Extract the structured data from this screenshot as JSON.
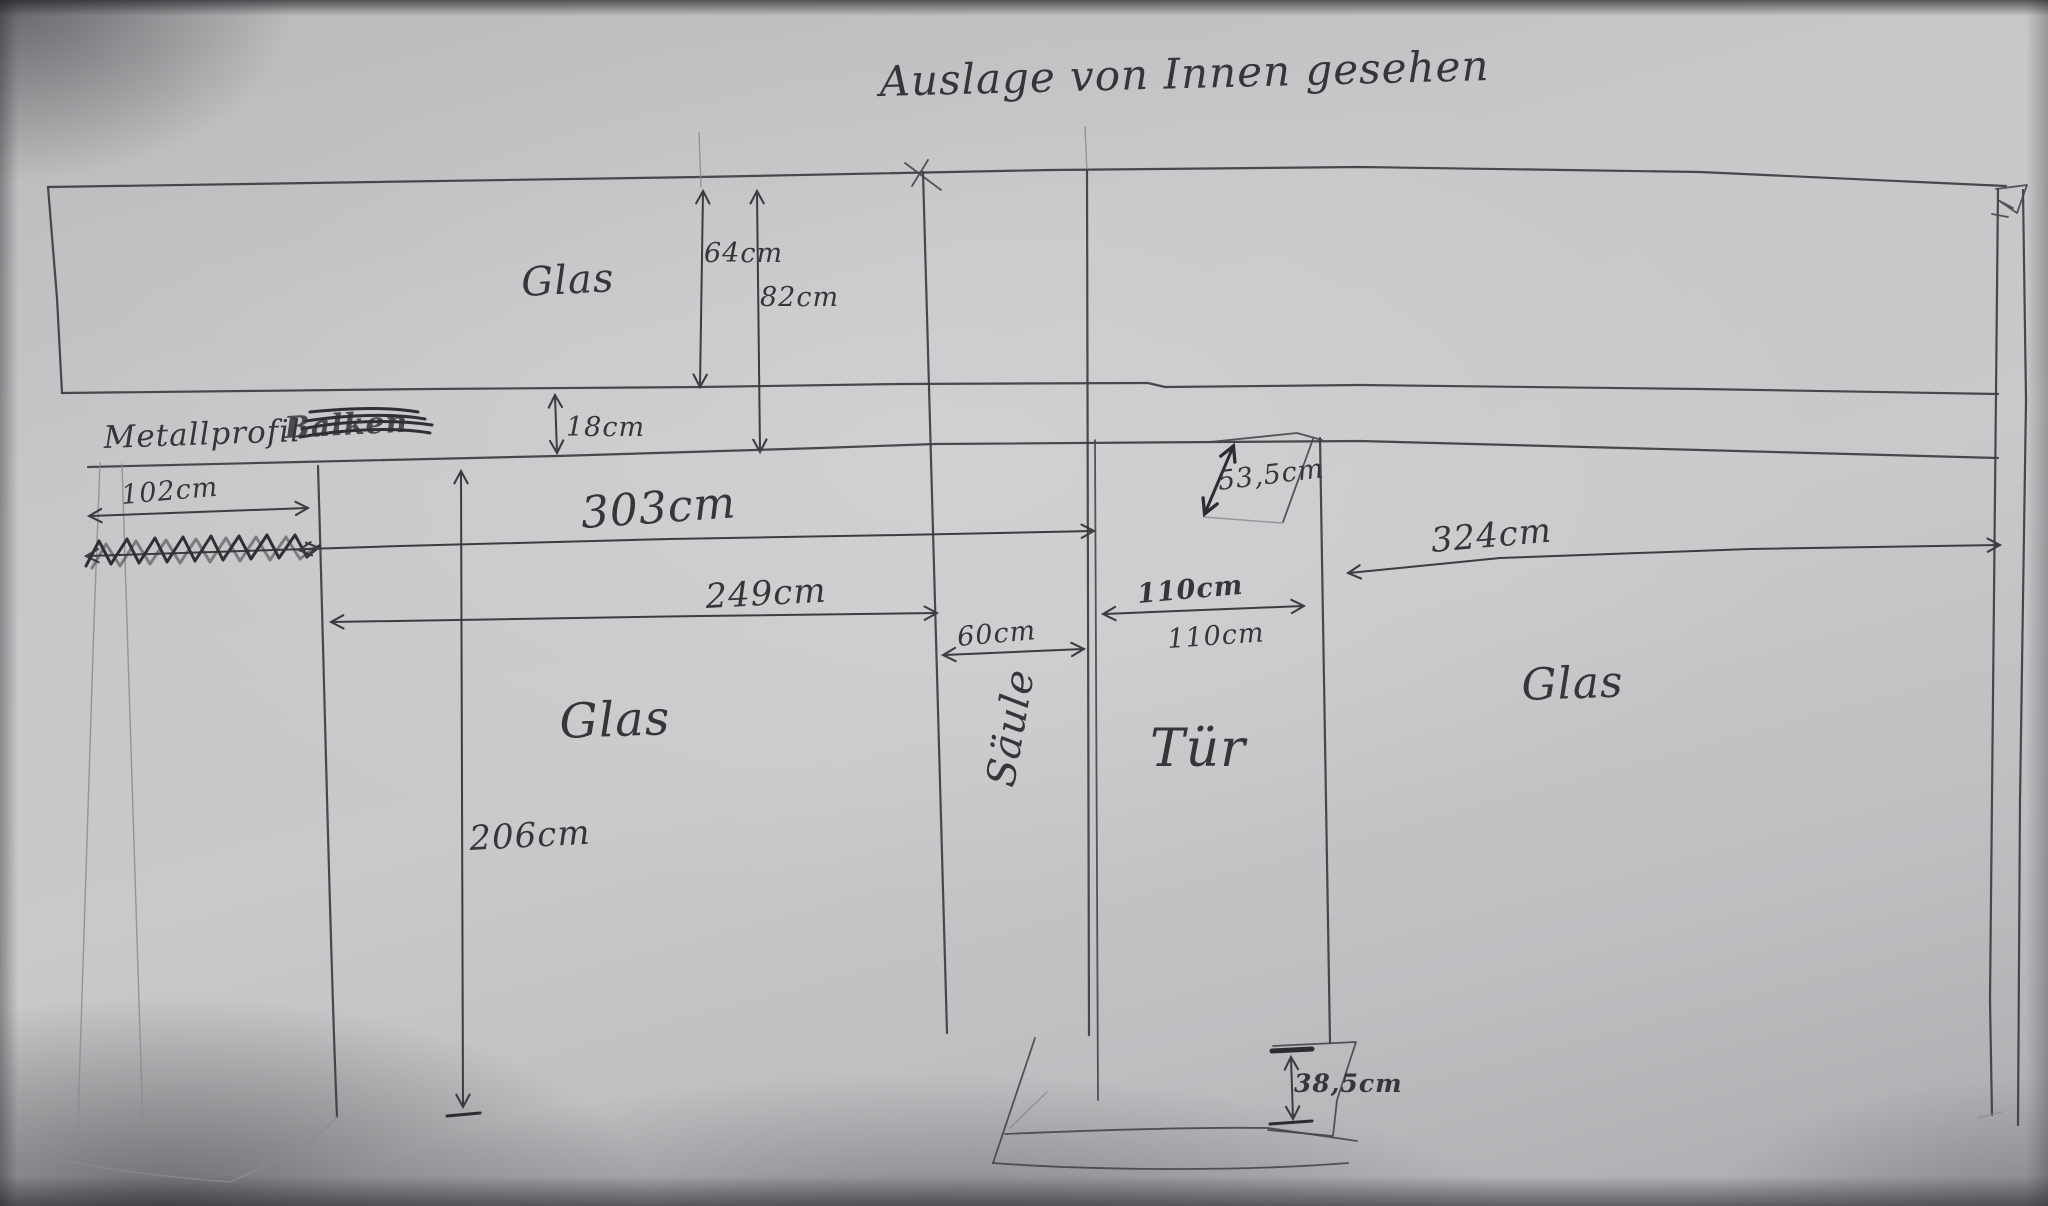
{
  "title": "Auslage von Innen gesehen",
  "labels": {
    "glas_top": "Glas",
    "metallprofil": "Metallprofil",
    "crossed_word": "Balken",
    "glas_left": "Glas",
    "saeule": "Säule",
    "tuer": "Tür",
    "glas_right": "Glas"
  },
  "dimensions": {
    "d64": "64cm",
    "d82": "82cm",
    "d18": "18cm",
    "d102": "102cm",
    "d303": "303cm",
    "d249": "249cm",
    "d60": "60cm",
    "d110_top": "110cm",
    "d110_bottom": "110cm",
    "d324": "324cm",
    "d53_5": "53,5cm",
    "d206": "206cm",
    "d38_5": "38,5cm"
  },
  "colors": {
    "pencil": "#3c3c41",
    "pencil_bold": "#2c2c30",
    "paper": "#c6c6c8"
  }
}
